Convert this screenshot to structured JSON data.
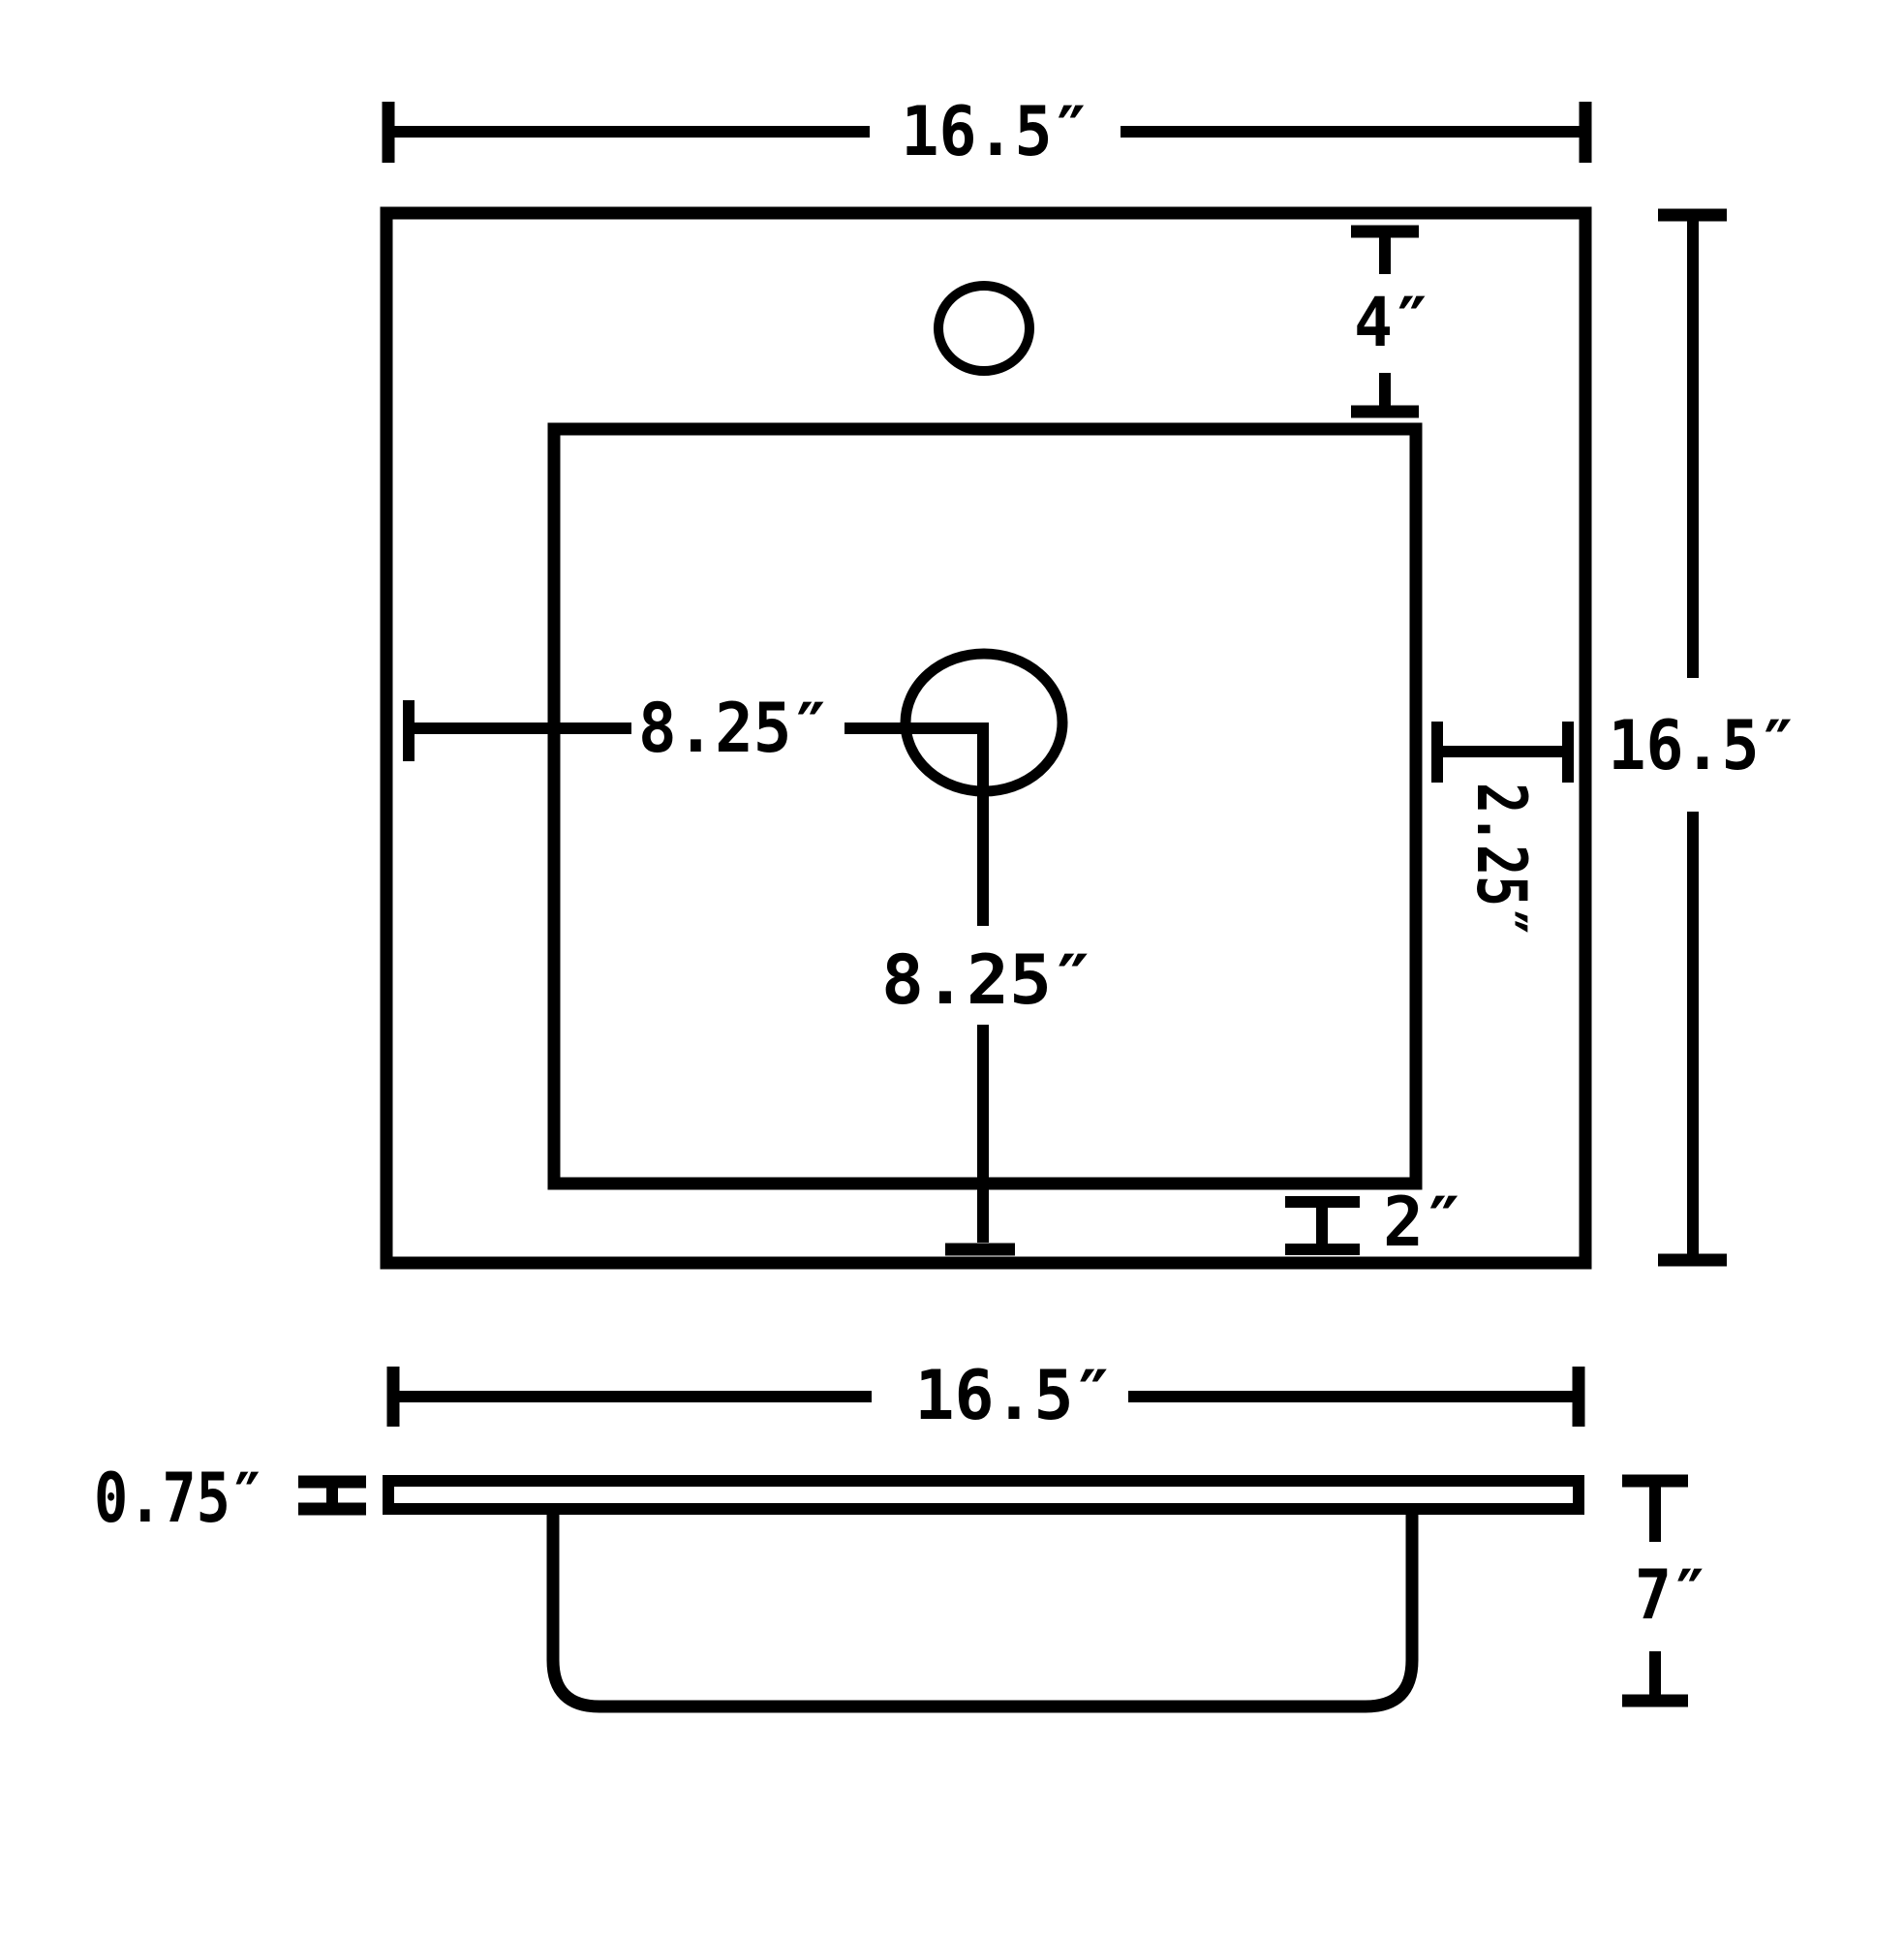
{
  "colors": {
    "ink": "#000000",
    "paper": "#ffffff"
  },
  "top_view": {
    "width_label": "16.5″",
    "height_label": "16.5″",
    "faucet_hole_offset_label": "4″",
    "drain_from_left_label": "8.25″",
    "drain_to_bottom_label": "8.25″",
    "right_rim_label": "2.25″",
    "bottom_rim_label": "2″"
  },
  "side_view": {
    "width_label": "16.5″",
    "deck_thickness_label": "0.75″",
    "bowl_depth_label": "7″"
  }
}
